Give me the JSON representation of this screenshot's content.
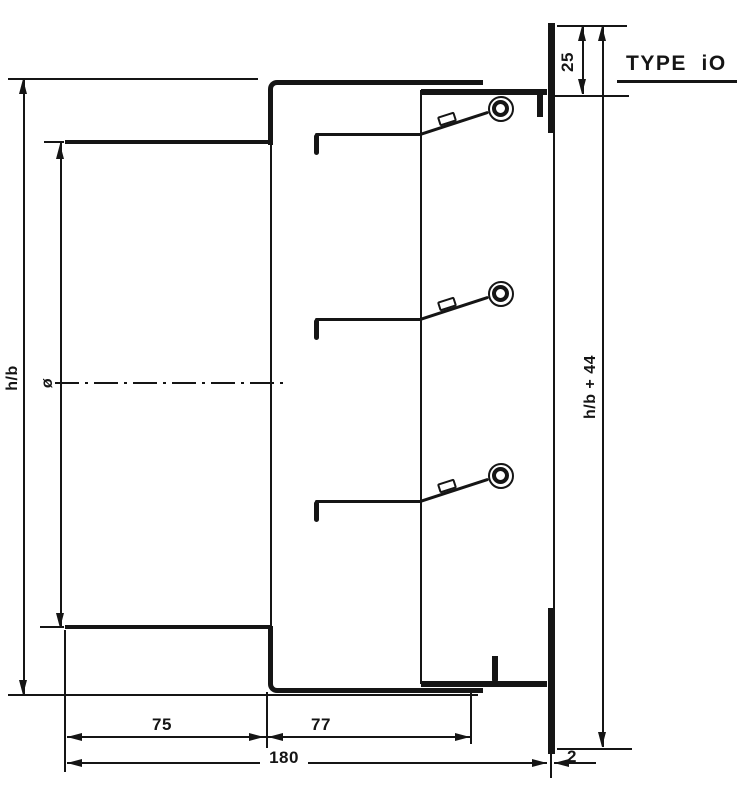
{
  "title": {
    "label": "TYPE  iO"
  },
  "dimensions": {
    "flange_offset": {
      "label": "25"
    },
    "overall_height": {
      "label": "h/b + 44"
    },
    "duct_height": {
      "label": "h/b"
    },
    "diameter": {
      "label": "ø"
    },
    "spigot_depth": {
      "label": "75"
    },
    "body_depth": {
      "label": "77"
    },
    "total_depth": {
      "label": "180"
    },
    "flange_thickness": {
      "label": "2"
    }
  }
}
